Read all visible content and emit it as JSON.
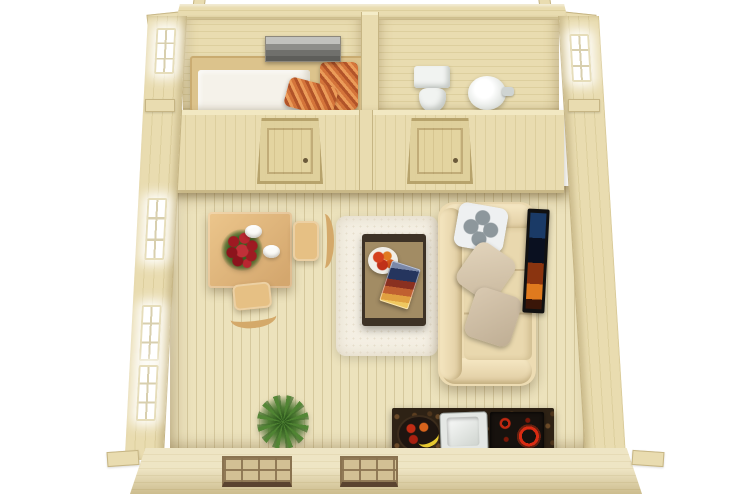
{
  "scene": {
    "type": "top-view-3d-floor-plan-render",
    "subject": "one-room log cabin with separate bedroom and bathroom",
    "background": "#ffffff",
    "rooms": [
      {
        "name": "bedroom",
        "position": "top-left",
        "items": [
          "seascape-wall-picture",
          "double-bed",
          "white-mattress",
          "orange-striped-pillow",
          "orange-striped-blanket",
          "window-left-wall"
        ]
      },
      {
        "name": "bathroom",
        "position": "top-right",
        "items": [
          "toilet",
          "round-washbasin",
          "faucet",
          "window-right-wall"
        ]
      },
      {
        "name": "living-room",
        "position": "bottom",
        "items": [
          "dining-table",
          "red-flower-bouquet",
          "two-white-cups",
          "wooden-chair-right",
          "wooden-chair-bottom",
          "white-shag-rug",
          "coffee-table",
          "fruit-plate",
          "magazine",
          "cream-sofa",
          "patterned-pillow",
          "beige-cushion",
          "taupe-cushion",
          "wall-mounted-tv",
          "potted-green-plant",
          "kitchen-counter",
          "fruit-bowl-with-banana",
          "kitchen-sink",
          "cooktop-with-red-burners",
          "three-lit-windows-left-wall",
          "two-front-windows",
          "interior-wall-with-two-doors"
        ]
      }
    ],
    "architecture": [
      "log-corner-joints",
      "plank-floor",
      "timber-walls",
      "partition-wall",
      "two-panel-doors"
    ]
  },
  "palette": {
    "bg": "#ffffff",
    "wood-light": "#e9dcb0",
    "wood-mid": "#ddcf9e",
    "wood-dark": "#c9b887",
    "wood-edge": "#c6b584",
    "floor": "#ece2bc",
    "floor-line": "#d5c89d",
    "mattress": "#f5f2ea",
    "pillow-orange": "#d4743a",
    "pillow-orange-dark": "#b25429",
    "pillow-orange-light": "#eb9c59",
    "picture-gray": "#8e8e8a",
    "fixture-white": "#f1f3f1",
    "table-wood": "#ecc68c",
    "table-wood-dark": "#d4a76e",
    "flower-red": "#9e1a22",
    "leaf-green": "#35621f",
    "rug-cream": "#f4efe3",
    "ctable-frame": "#3d3226",
    "ctable-top": "#a28c64",
    "sofa-cream": "#eddcb3",
    "sofa-shade": "#dfcba0",
    "cushion-beige": "#c9b89e",
    "cushion-taupe": "#bfae94",
    "pillow-white": "#eef0f1",
    "pillow-gray": "#8d979c",
    "tv-black": "#111111",
    "screen-blue": "#1a3a66",
    "screen-orange": "#df7a1e",
    "plant-green": "#4f8432",
    "plant-dark": "#2f5a1e",
    "counter-dark": "#2e2215",
    "granite-fleck": "#6b4a28",
    "ring-red": "#d92b12",
    "cooktop-black": "#17120e",
    "sink-steel": "#e4e7e4",
    "banana-yellow": "#e6c830",
    "window-glow": "#ffffff",
    "pane-tan": "#d2c094",
    "sill-brown": "#5a4330"
  }
}
